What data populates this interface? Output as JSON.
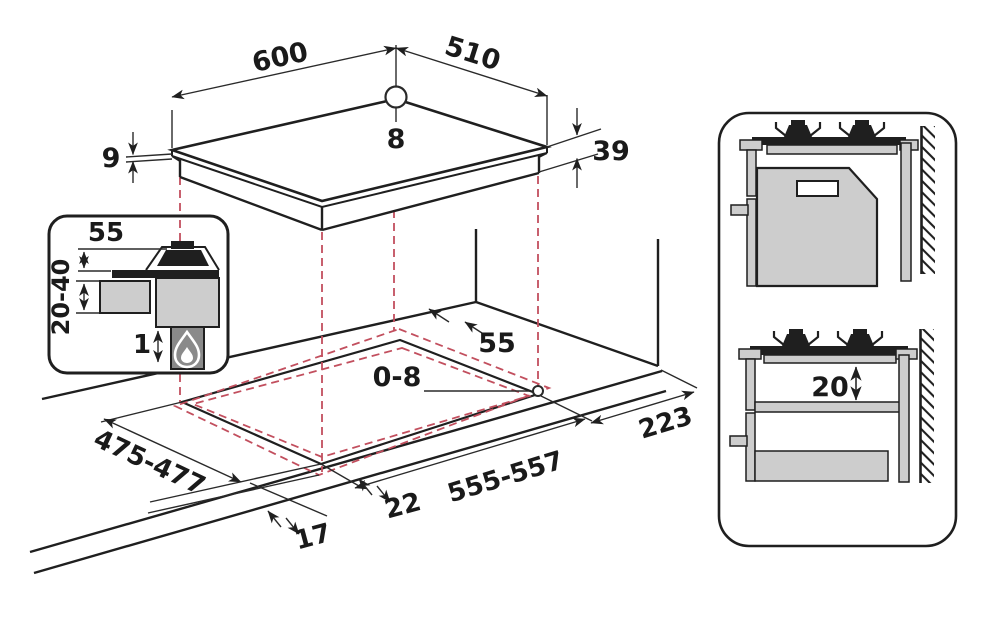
{
  "title": "Gas hob installation dimensions diagram",
  "labels": {
    "hob_width": "600",
    "hob_depth": "510",
    "hole_diameter": "8",
    "glass_thickness": "9",
    "body_height": "39",
    "cutout_rear_clearance": "55",
    "hole_position_range": "0-8",
    "right_clearance": "223",
    "cutout_depth": "475-477",
    "cutout_width": "555-557",
    "overlap_a": "22",
    "overlap_b": "17",
    "shelf_clearance": "20"
  },
  "detail_inset": {
    "burner_height": "55",
    "cabinet_clearance": "20-40",
    "min_gap": "1",
    "flame_icon": "flame"
  },
  "colors": {
    "line": "#1f1f1f",
    "dashed_projection": "#c24f5e",
    "fill_light_gray": "#cdcdcd",
    "fill_dark_gray": "#8a8a8a",
    "background": "#ffffff"
  }
}
